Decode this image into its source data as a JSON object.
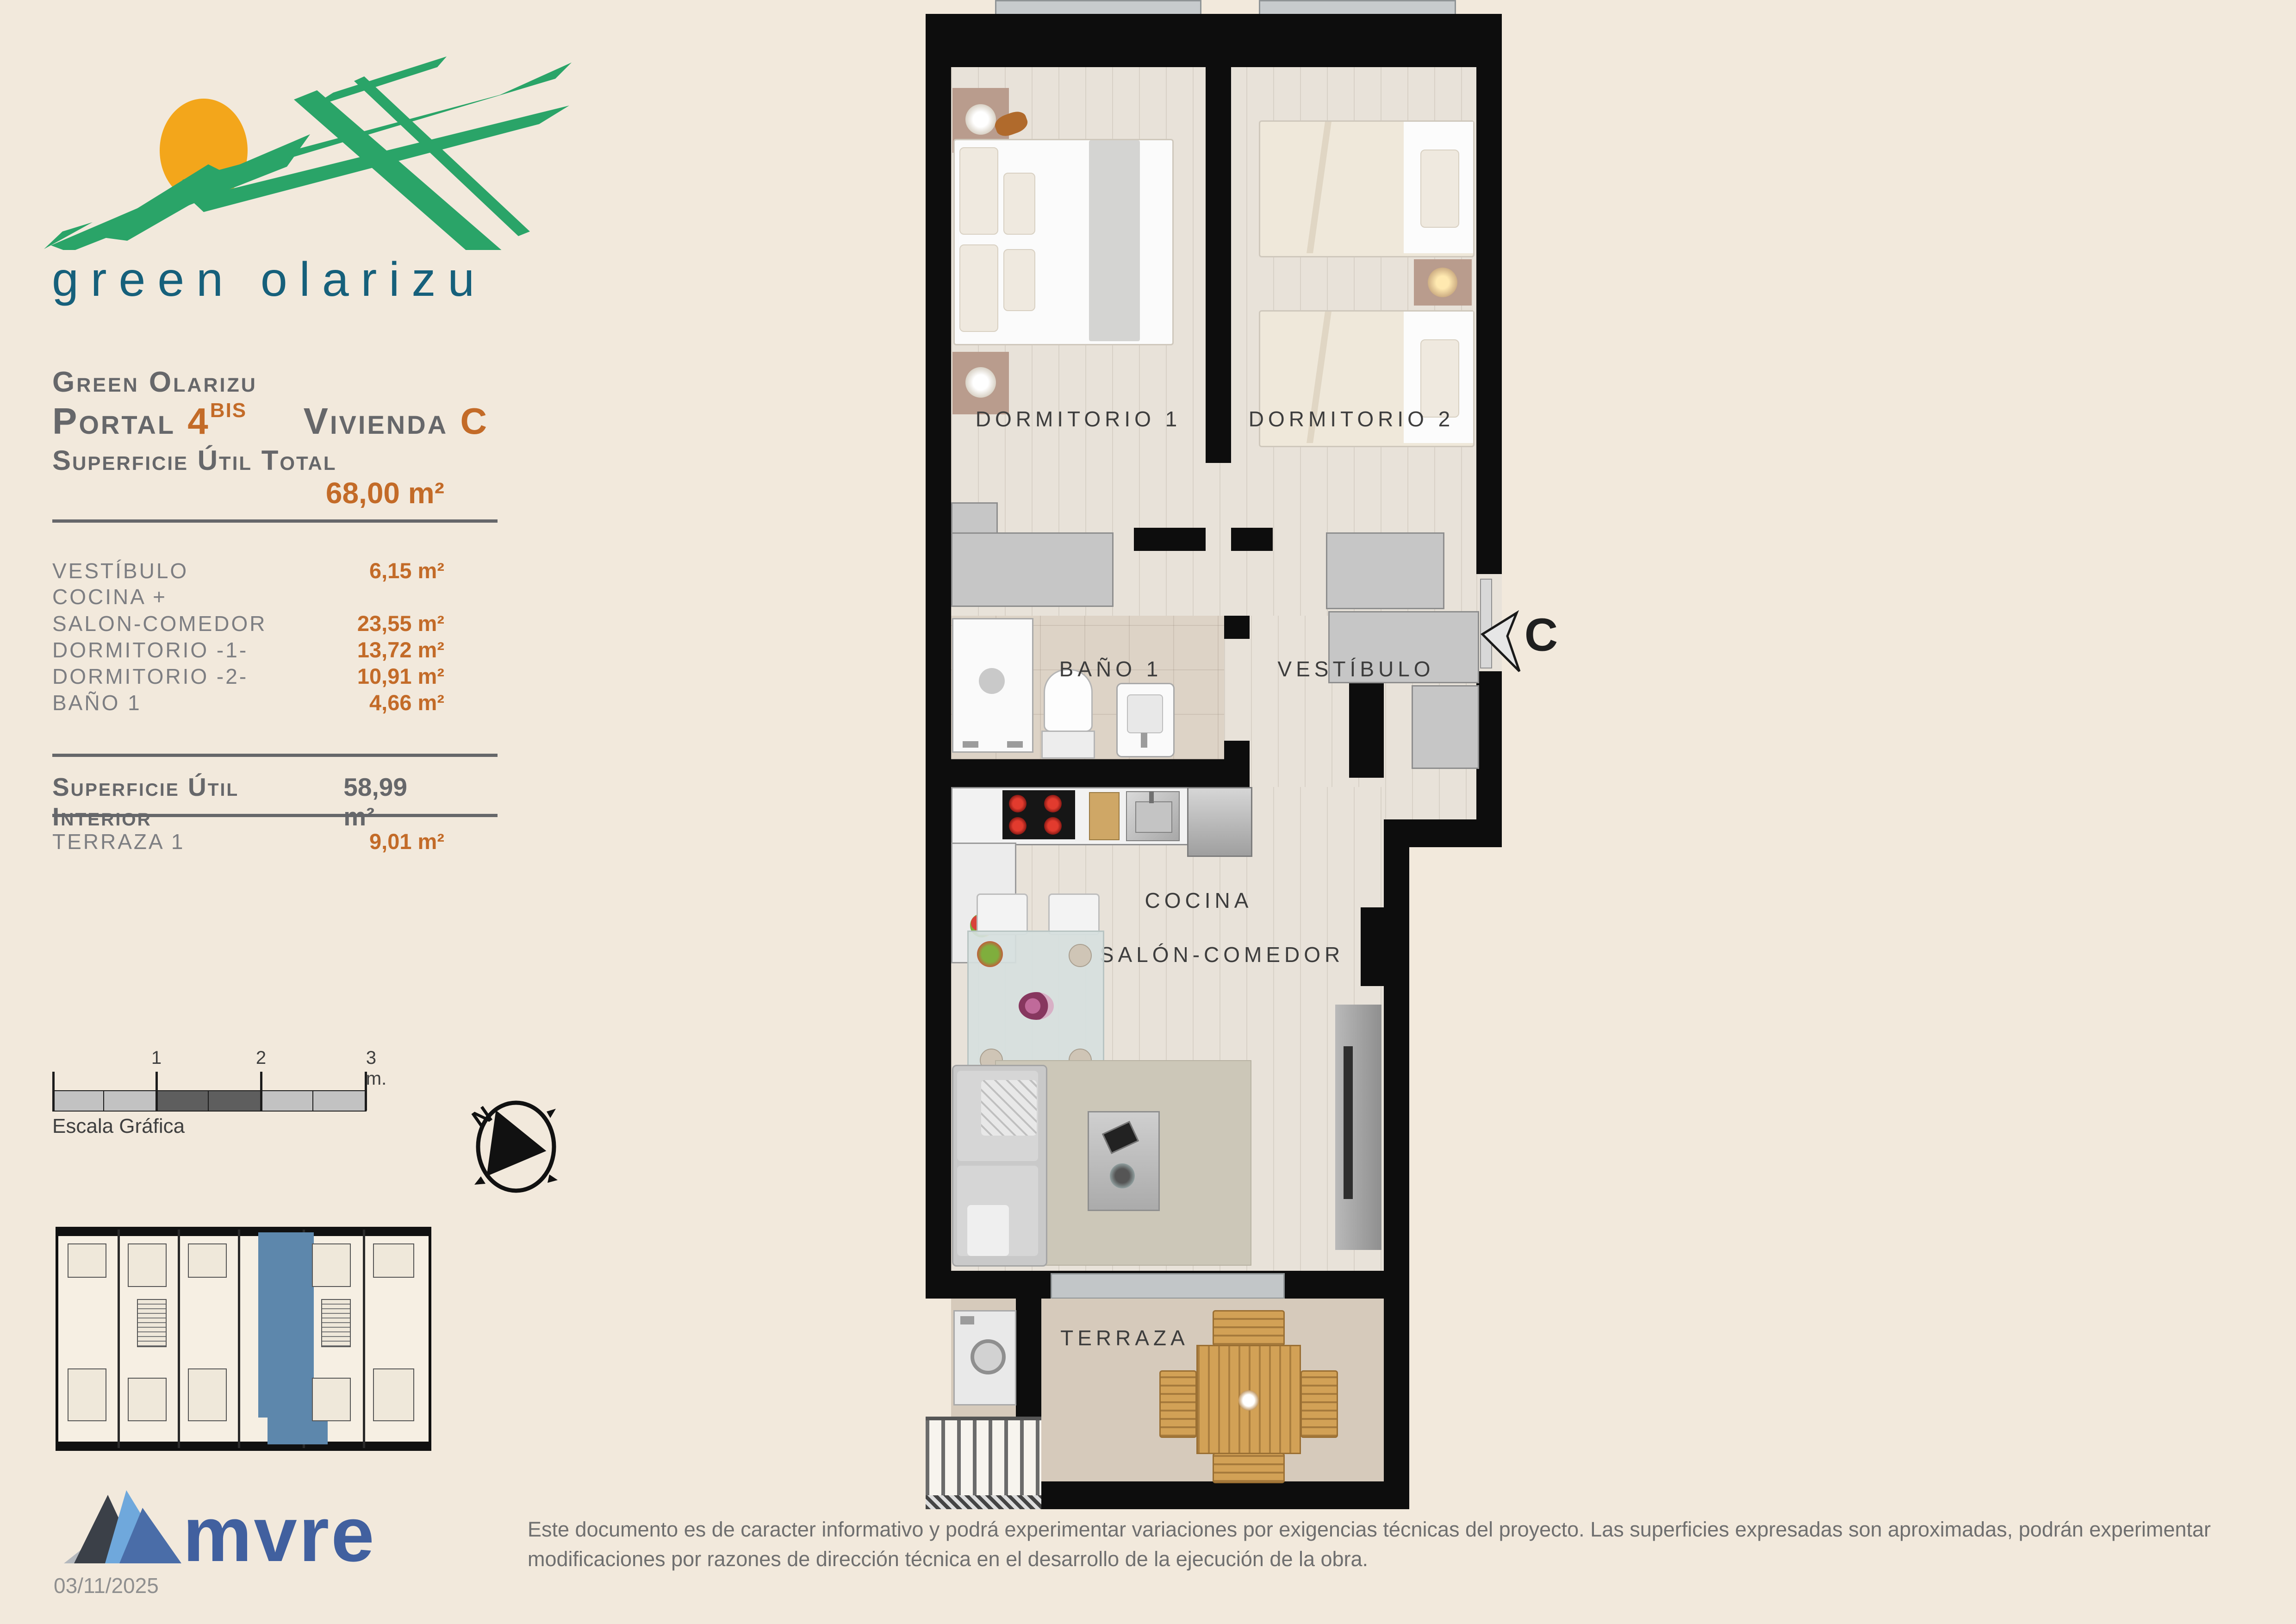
{
  "colors": {
    "background": "#f2e9dc",
    "accent_orange": "#c36b28",
    "heading_gray": "#66676a",
    "logo_green": "#2aa468",
    "logo_sun": "#f3a61b",
    "logo_teal": "#16607b",
    "mvre_blue": "#41609f",
    "keyplan_highlight": "#5d87ac"
  },
  "logo": {
    "wordmark": "green olarizu"
  },
  "header": {
    "project": "Green Olarizu",
    "portal_label": "Portal",
    "portal_number": "4",
    "portal_sup": "BIS",
    "vivienda_label": "Vivienda",
    "vivienda_letter": "C"
  },
  "surface": {
    "total_label": "Superficie Útil Total",
    "total_value": "68,00 m²",
    "rows": [
      {
        "label": "VESTÍBULO",
        "value": "6,15 m²"
      },
      {
        "label": "COCINA +",
        "value": ""
      },
      {
        "label": "SALON-COMEDOR",
        "value": "23,55 m²"
      },
      {
        "label": "DORMITORIO -1-",
        "value": "13,72 m²"
      },
      {
        "label": "DORMITORIO -2-",
        "value": "10,91 m²"
      },
      {
        "label": "BAÑO 1",
        "value": "4,66 m²"
      }
    ],
    "interior_label": "Superficie Útil Interior",
    "interior_value": "58,99 m²",
    "terrace_label": "TERRAZA 1",
    "terrace_value": "9,01 m²"
  },
  "plan": {
    "rooms": [
      "DORMITORIO 1",
      "DORMITORIO 2",
      "BAÑO 1",
      "VESTÍBULO",
      "COCINA",
      "SALÓN-COMEDOR",
      "TERRAZA"
    ],
    "entrance_letter": "C"
  },
  "scalebar": {
    "tick1": "1",
    "tick2": "2",
    "tick3": "3 m.",
    "caption": "Escala Gráfica"
  },
  "compass": {
    "north": "N"
  },
  "footer": {
    "brand": "mvre",
    "date": "03/11/2025",
    "disclaimer": "Este documento es de caracter informativo y podrá experimentar variaciones por exigencias técnicas del proyecto. Las superficies expresadas son aproximadas, podrán experimentar modificaciones por razones de dirección técnica en el desarrollo de la ejecución de la obra."
  }
}
